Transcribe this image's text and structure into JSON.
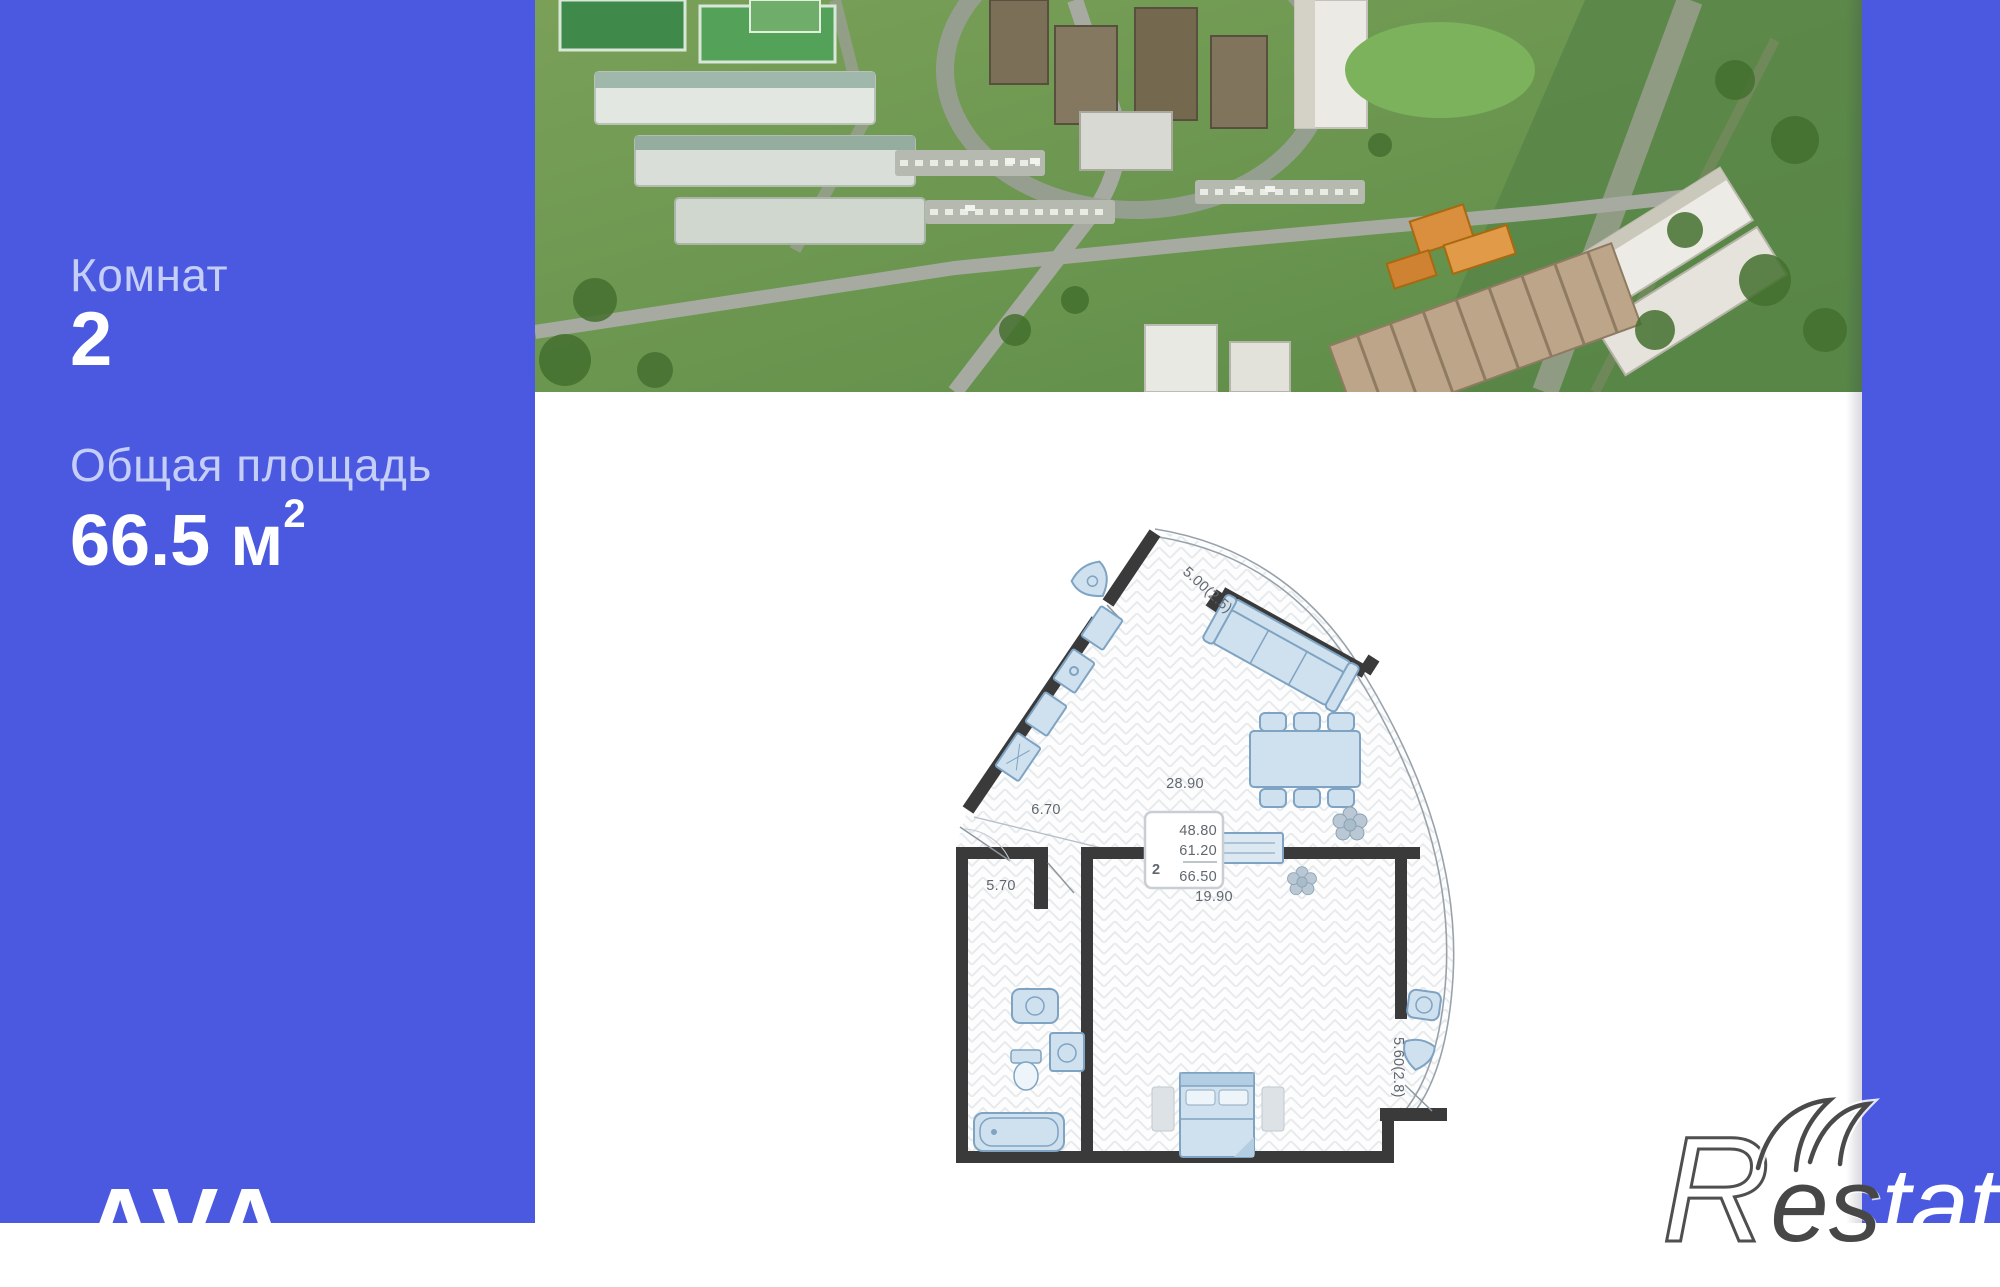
{
  "panel": {
    "rooms_label": "Комнат",
    "rooms_value": "2",
    "area_label": "Общая площадь",
    "area_value": "66.5",
    "area_unit": "м",
    "area_sup": "2",
    "brand": "AVA"
  },
  "floorplan": {
    "rooms_count": "2",
    "stats": {
      "living_area": "48.80",
      "apartment_area": "61.20",
      "total_area": "66.50"
    },
    "labels": {
      "kitchen_living": "28.90",
      "hallway": "6.70",
      "bathroom": "5.70",
      "bedroom": "19.90",
      "balcony_top": "5.00(2.5)",
      "balcony_right": "5.60(2.8)"
    }
  },
  "watermark": {
    "r": "R",
    "es": "es",
    "tate": "tate"
  },
  "colors": {
    "accent_blue": "#4a59e0",
    "wall_dark": "#3a3a3a",
    "furniture_blue": "#cfe1ef",
    "label_gray": "#60676e"
  }
}
